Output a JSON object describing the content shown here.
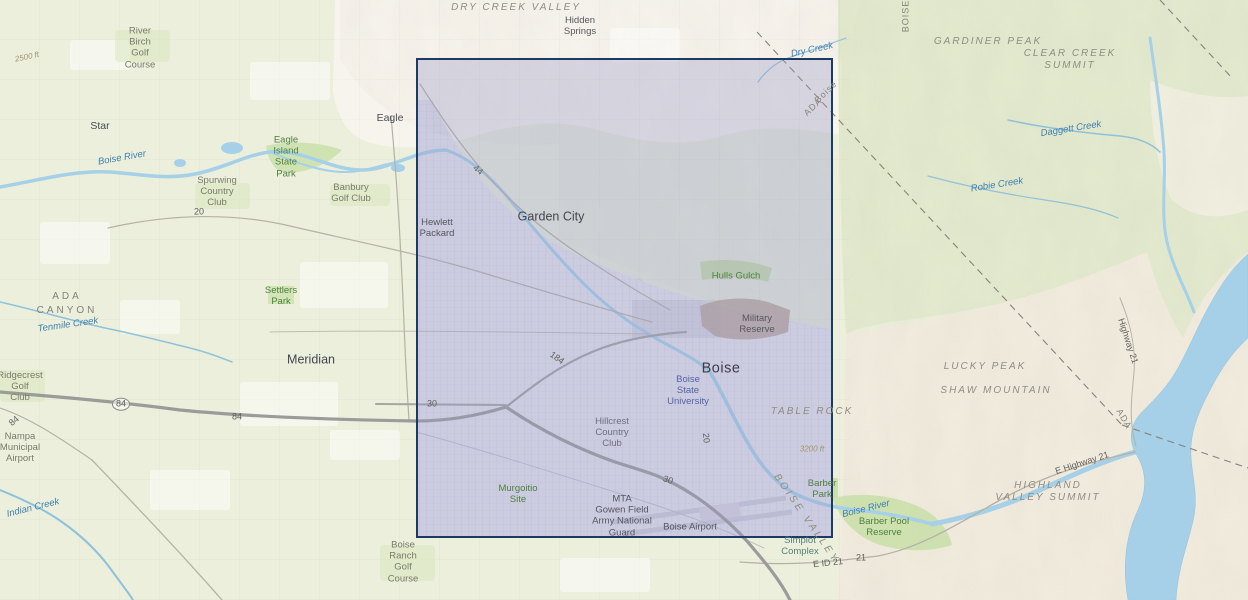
{
  "app": {
    "type": "map-viewer",
    "description": "Topographic basemap of the Boise, Idaho area with a rectangular selection extent drawn over the city of Boise"
  },
  "theme": {
    "colors": {
      "base-green": "#ebefdc",
      "hills-green": "#e3eace",
      "mountain-tan": "#f2ecdf",
      "foothills-white": "#f7f4ed",
      "water": "#a5d0e7",
      "park-green": "#cfe3b2",
      "urban-fill": "#e7e6ee",
      "road-major": "#9b9b99",
      "road-minor": "#b5b1a7",
      "military-brown": "#b9a497",
      "selection-border": "#1d3a63",
      "selection-fill": "rgba(150,152,200,0.33)"
    }
  },
  "selection": {
    "x": 416,
    "y": 58,
    "width": 417,
    "height": 480
  },
  "map": {
    "labels": [
      {
        "name": "label-dry-creek-valley",
        "kind": "area",
        "x": 516,
        "y": 8,
        "rot": 0,
        "text": "DRY CREEK VALLEY"
      },
      {
        "name": "label-hidden-springs",
        "kind": "place-sm",
        "x": 580,
        "y": 26,
        "rot": 0,
        "text": "Hidden\nSprings"
      },
      {
        "name": "label-gardiner-peak",
        "kind": "area",
        "x": 988,
        "y": 42,
        "rot": 0,
        "text": "GARDINER PEAK"
      },
      {
        "name": "label-clear-creek-summit",
        "kind": "area",
        "x": 1070,
        "y": 60,
        "rot": 0,
        "text": "CLEAR CREEK\nSUMMIT"
      },
      {
        "name": "label-dry-creek",
        "kind": "water",
        "x": 812,
        "y": 50,
        "rot": -12,
        "text": "Dry Creek"
      },
      {
        "name": "label-boise-county-diagonal",
        "kind": "county",
        "x": 826,
        "y": 92,
        "rot": -44,
        "text": "Boise"
      },
      {
        "name": "label-ada-county-diagonal",
        "kind": "county",
        "x": 813,
        "y": 107,
        "rot": -44,
        "text": "ADA"
      },
      {
        "name": "label-boise-county-vertical",
        "kind": "county",
        "x": 906,
        "y": 16,
        "rot": -90,
        "text": "BOISE"
      },
      {
        "name": "label-daggett-creek",
        "kind": "water",
        "x": 1071,
        "y": 129,
        "rot": -9,
        "text": "Daggett Creek"
      },
      {
        "name": "label-river-birch-golf-course",
        "kind": "golf",
        "x": 140,
        "y": 48,
        "rot": 0,
        "text": "River\nBirch\nGolf\nCourse"
      },
      {
        "name": "label-star",
        "kind": "place",
        "x": 100,
        "y": 126,
        "rot": 0,
        "text": "Star"
      },
      {
        "name": "label-eagle",
        "kind": "place",
        "x": 390,
        "y": 118,
        "rot": 0,
        "text": "Eagle"
      },
      {
        "name": "label-eagle-island-state-park",
        "kind": "park",
        "x": 286,
        "y": 157,
        "rot": 0,
        "text": "Eagle\nIsland\nState\nPark"
      },
      {
        "name": "label-spurwing-country-club",
        "kind": "golf",
        "x": 217,
        "y": 192,
        "rot": 0,
        "text": "Spurwing\nCountry\nClub"
      },
      {
        "name": "label-banbury-golf-club",
        "kind": "golf",
        "x": 351,
        "y": 193,
        "rot": 0,
        "text": "Banbury\nGolf Club"
      },
      {
        "name": "label-boise-river-west",
        "kind": "water",
        "x": 122,
        "y": 158,
        "rot": -10,
        "text": "Boise River"
      },
      {
        "name": "label-us20-west",
        "kind": "roadnum",
        "x": 199,
        "y": 212,
        "rot": 0,
        "text": "20"
      },
      {
        "name": "label-hewlett-packard",
        "kind": "place-sm",
        "x": 437,
        "y": 228,
        "rot": 0,
        "text": "Hewlett\nPackard"
      },
      {
        "name": "label-garden-city",
        "kind": "place-lg",
        "x": 551,
        "y": 217,
        "rot": 0,
        "text": "Garden City"
      },
      {
        "name": "label-route-44",
        "kind": "roadnum",
        "x": 478,
        "y": 170,
        "rot": 40,
        "text": "44"
      },
      {
        "name": "label-hulls-gulch",
        "kind": "park",
        "x": 736,
        "y": 276,
        "rot": 0,
        "text": "Hulls Gulch"
      },
      {
        "name": "label-military-reserve",
        "kind": "place-sm",
        "x": 757,
        "y": 324,
        "rot": 0,
        "text": "Military\nReserve"
      },
      {
        "name": "label-boise",
        "kind": "city",
        "x": 721,
        "y": 369,
        "rot": 0,
        "text": "Boise"
      },
      {
        "name": "label-boise-state-university",
        "kind": "bsu",
        "x": 688,
        "y": 391,
        "rot": 0,
        "text": "Boise\nState\nUniversity"
      },
      {
        "name": "label-table-rock",
        "kind": "area",
        "x": 812,
        "y": 412,
        "rot": 0,
        "text": "TABLE ROCK"
      },
      {
        "name": "label-robie-creek",
        "kind": "water",
        "x": 997,
        "y": 185,
        "rot": -9,
        "text": "Robie Creek"
      },
      {
        "name": "label-lucky-peak",
        "kind": "area",
        "x": 985,
        "y": 367,
        "rot": 0,
        "text": "LUCKY PEAK"
      },
      {
        "name": "label-shaw-mountain",
        "kind": "area",
        "x": 996,
        "y": 391,
        "rot": 0,
        "text": "SHAW MOUNTAIN"
      },
      {
        "name": "label-highway-21-vertical",
        "kind": "roadnum",
        "x": 1128,
        "y": 341,
        "rot": 72,
        "text": "Highway 21"
      },
      {
        "name": "label-ada-county-diagonal-east",
        "kind": "county",
        "x": 1124,
        "y": 419,
        "rot": 60,
        "text": "ADA"
      },
      {
        "name": "label-e-highway-21",
        "kind": "roadnum",
        "x": 1082,
        "y": 463,
        "rot": -18,
        "text": "E Highway 21"
      },
      {
        "name": "label-highland-valley-summit",
        "kind": "area",
        "x": 1048,
        "y": 492,
        "rot": 0,
        "text": "HIGHLAND\nVALLEY SUMMIT"
      },
      {
        "name": "label-ada-county-west",
        "kind": "county-wide",
        "x": 67,
        "y": 297,
        "rot": 0,
        "text": "ADA"
      },
      {
        "name": "label-canyon-county-west",
        "kind": "county-wide",
        "x": 67,
        "y": 311,
        "rot": 0,
        "text": "CANYON"
      },
      {
        "name": "label-tenmile-creek",
        "kind": "water",
        "x": 68,
        "y": 325,
        "rot": -8,
        "text": "Tenmile Creek"
      },
      {
        "name": "label-settlers-park",
        "kind": "park",
        "x": 281,
        "y": 296,
        "rot": 0,
        "text": "Settlers\nPark"
      },
      {
        "name": "label-meridian",
        "kind": "place-lg",
        "x": 311,
        "y": 360,
        "rot": 0,
        "text": "Meridian"
      },
      {
        "name": "label-ridgecrest-golf-club",
        "kind": "golf",
        "x": 20,
        "y": 387,
        "rot": 0,
        "text": "Ridgecrest\nGolf\nClub"
      },
      {
        "name": "label-i84-shield",
        "kind": "roadnum",
        "badge": true,
        "x": 121,
        "y": 404,
        "rot": 0,
        "text": "84"
      },
      {
        "name": "label-i84",
        "kind": "roadnum",
        "x": 237,
        "y": 417,
        "rot": 0,
        "text": "84"
      },
      {
        "name": "label-hwy84-diagonal",
        "kind": "roadnum",
        "x": 14,
        "y": 421,
        "rot": -40,
        "text": "84"
      },
      {
        "name": "label-nampa-municipal-airport",
        "kind": "golf",
        "x": 20,
        "y": 448,
        "rot": 0,
        "text": "Nampa\nMunicipal\nAirport"
      },
      {
        "name": "label-indian-creek",
        "kind": "water",
        "x": 33,
        "y": 508,
        "rot": -14,
        "text": "Indian Creek"
      },
      {
        "name": "label-us30-west",
        "kind": "roadnum",
        "x": 432,
        "y": 404,
        "rot": 0,
        "text": "30"
      },
      {
        "name": "label-i184",
        "kind": "roadnum",
        "x": 557,
        "y": 358,
        "rot": 35,
        "text": "184"
      },
      {
        "name": "label-us20-vertical",
        "kind": "roadnum",
        "x": 706,
        "y": 438,
        "rot": 85,
        "text": "20"
      },
      {
        "name": "label-hillcrest-country-club",
        "kind": "golf-in",
        "x": 612,
        "y": 433,
        "rot": 0,
        "text": "Hillcrest\nCountry\nClub"
      },
      {
        "name": "label-murgoitio-site",
        "kind": "park",
        "x": 518,
        "y": 494,
        "rot": 0,
        "text": "Murgoitio\nSite"
      },
      {
        "name": "label-mta-gowen-field",
        "kind": "place-sm",
        "x": 622,
        "y": 516,
        "rot": 0,
        "text": "MTA\nGowen Field\nArmy National\nGuard"
      },
      {
        "name": "label-boise-airport",
        "kind": "place-sm",
        "x": 690,
        "y": 527,
        "rot": 0,
        "text": "Boise Airport"
      },
      {
        "name": "label-us30-east",
        "kind": "roadnum",
        "x": 668,
        "y": 480,
        "rot": 20,
        "text": "30"
      },
      {
        "name": "label-boise-valley",
        "kind": "area-rot",
        "x": 806,
        "y": 519,
        "rot": 55,
        "text": "BOISE VALLEY"
      },
      {
        "name": "label-barber-park",
        "kind": "park",
        "x": 822,
        "y": 489,
        "rot": 0,
        "text": "Barber\nPark"
      },
      {
        "name": "label-boise-river-east",
        "kind": "water",
        "x": 866,
        "y": 509,
        "rot": -14,
        "text": "Boise River"
      },
      {
        "name": "label-barber-pool-reserve",
        "kind": "park",
        "x": 884,
        "y": 527,
        "rot": 0,
        "text": "Barber Pool\nReserve"
      },
      {
        "name": "label-simplot-complex",
        "kind": "teal",
        "x": 800,
        "y": 546,
        "rot": 0,
        "text": "Simplot\nComplex"
      },
      {
        "name": "label-e-id-21",
        "kind": "roadnum",
        "x": 828,
        "y": 563,
        "rot": -6,
        "text": "E ID 21"
      },
      {
        "name": "label-id-21",
        "kind": "roadnum",
        "x": 861,
        "y": 558,
        "rot": 0,
        "text": "21"
      },
      {
        "name": "label-boise-ranch-golf-course",
        "kind": "golf",
        "x": 403,
        "y": 562,
        "rot": 0,
        "text": "Boise\nRanch\nGolf\nCourse"
      },
      {
        "name": "label-contour-2500",
        "kind": "contour",
        "x": 27,
        "y": 57,
        "rot": -12,
        "text": "2500 ft"
      },
      {
        "name": "label-contour-3200",
        "kind": "contour",
        "x": 812,
        "y": 449,
        "rot": 0,
        "text": "3200 ft"
      }
    ]
  }
}
